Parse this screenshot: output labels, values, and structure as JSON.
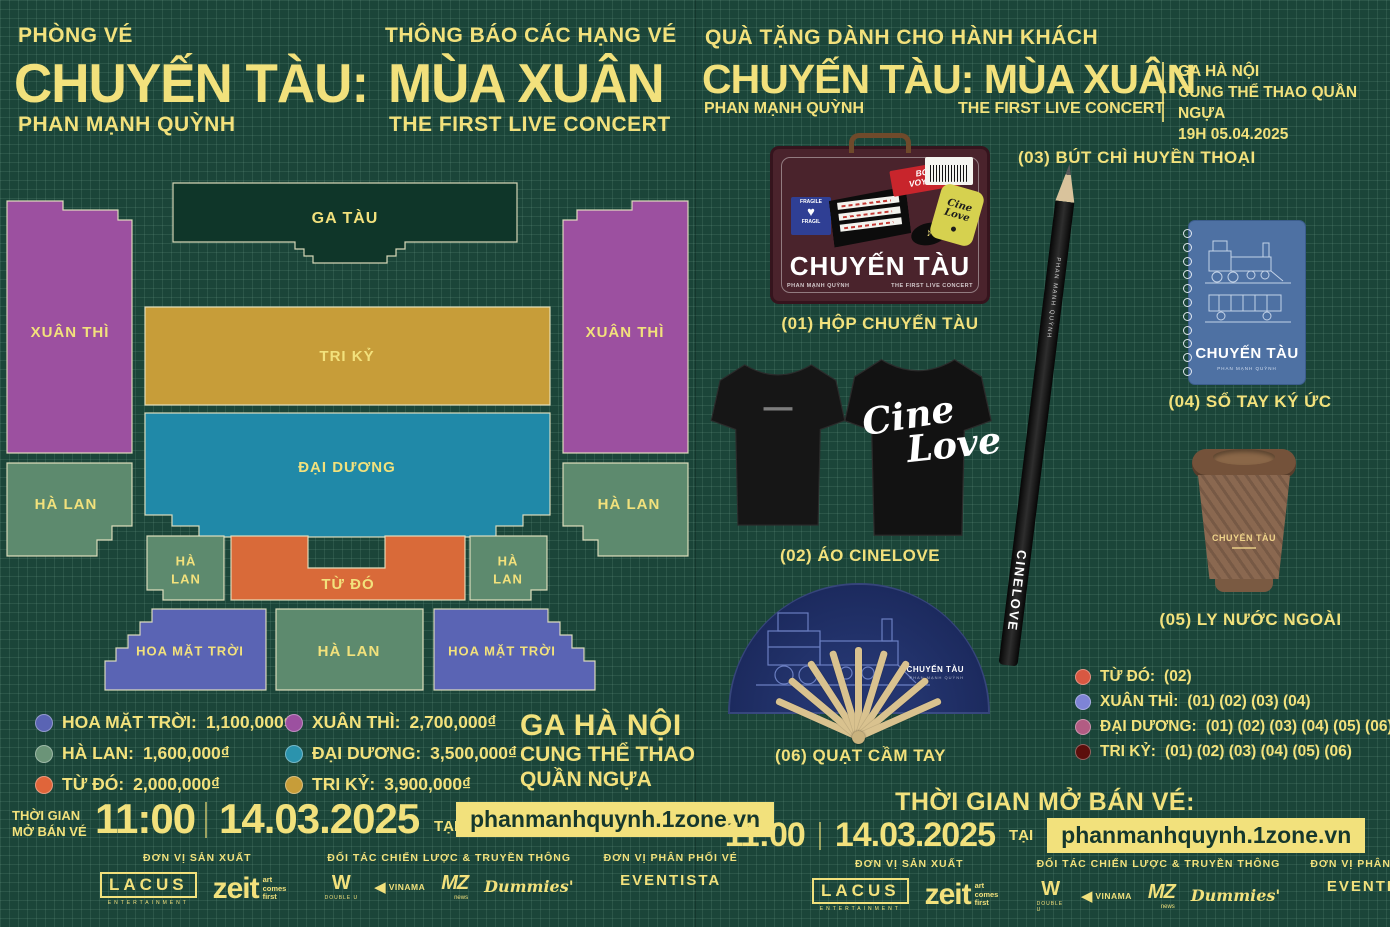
{
  "theme": {
    "bg": "#1b4539",
    "grid_line": "#8cc8af",
    "yellow": "#f2e17c",
    "stage_fill": "#0f3629",
    "url_box_bg": "#f2e17c",
    "url_box_text": "#16382d",
    "seat_colors": {
      "xuan_thi": "#9c50a0",
      "tri_ky": "#c79d39",
      "dai_duong": "#2089a8",
      "ha_lan": "#5d8a6e",
      "tu_do": "#d96a39",
      "hoa_mat_troi": "#5a64b4"
    },
    "gift_dot_colors": {
      "tu_do": "#d85842",
      "xuan_thi": "#7e84d6",
      "dai_duong": "#b25c83",
      "tri_ky": "#5c0f0c"
    },
    "icons": {
      "heart": "♥",
      "note": "♪"
    }
  },
  "left": {
    "kicker": "PHÒNG VÉ",
    "notice": "THÔNG BÁO CÁC HẠNG VÉ",
    "title_a": "CHUYẾN TÀU:",
    "title_b": "MÙA XUÂN",
    "artist": "PHAN MẠNH QUỲNH",
    "subtitle": "THE FIRST LIVE CONCERT",
    "map": {
      "stage": "GA TÀU",
      "xuan_thi": "XUÂN THÌ",
      "tri_ky": "TRI KỶ",
      "dai_duong": "ĐẠI DƯƠNG",
      "ha_lan": "HÀ LAN",
      "ha_lan_1": "HÀ",
      "ha_lan_2": "LAN",
      "tu_do": "TỪ ĐÓ",
      "hoa_mat_troi": "HOA MẶT TRỜI"
    },
    "legend": [
      {
        "label": "HOA MẶT TRỜI:",
        "price": "1,100,000₫"
      },
      {
        "label": "HÀ LAN:",
        "price": "1,600,000₫"
      },
      {
        "label": "TỪ ĐÓ:",
        "price": "2,000,000₫"
      },
      {
        "label": "XUÂN THÌ:",
        "price": "2,700,000₫"
      },
      {
        "label": "ĐẠI DƯƠNG:",
        "price": "3,500,000₫"
      },
      {
        "label": "TRI KỶ:",
        "price": "3,900,000₫"
      }
    ],
    "venue": {
      "line1": "GA HÀ NỘI",
      "line2": "CUNG THỂ THAO",
      "line3": "QUẦN NGỰA"
    },
    "sale": {
      "label_1": "THỜI GIAN",
      "label_2": "MỞ BÁN VÉ",
      "time": "11:00",
      "date": "14.03.2025",
      "at": "TẠI",
      "url": "phanmanhquynh.1zone.vn"
    }
  },
  "right": {
    "kicker": "QUÀ TẶNG DÀNH CHO HÀNH KHÁCH",
    "title": "CHUYẾN TÀU: MÙA XUÂN",
    "artist": "PHAN MẠNH QUỲNH",
    "subtitle": "THE FIRST LIVE CONCERT",
    "event_info": {
      "line1": "GA HÀ NỘI",
      "line2": "CUNG THỂ THAO QUẦN NGỰA",
      "line3": "19H 05.04.2025"
    },
    "gifts": {
      "g01": "(01) HỘP CHUYẾN TÀU",
      "g02": "(02) ÁO CINELOVE",
      "g03": "(03) BÚT CHÌ HUYỀN THOẠI",
      "g04": "(04) SỔ TAY KÝ ỨC",
      "g05": "(05) LY NƯỚC NGOÀI",
      "g06": "(06) QUẠT CẦM TAY"
    },
    "items": {
      "suitcase": {
        "title": "CHUYẾN TÀU",
        "artist": "PHAN MẠNH QUỲNH",
        "subtitle": "THE FIRST LIVE CONCERT",
        "sticker_fragile": "FRAGILE",
        "sticker_fragile_2": "FRAGIL",
        "sticker_bon_1": "BON",
        "sticker_bon_2": "VOYAGE",
        "sticker_cine": "Cine Love"
      },
      "tshirt_back_1": "Cine",
      "tshirt_back_2": "Love",
      "pencil_brand": "PHAN MẠNH QUỲNH",
      "pencil_text": "CINELOVE",
      "notebook_title": "CHUYẾN TÀU",
      "notebook_sub": "PHAN MẠNH QUỲNH",
      "cup_title": "CHUYẾN TÀU",
      "fan_title": "CHUYẾN TÀU",
      "fan_sub": "PHAN MẠNH QUỲNH"
    },
    "gift_map": [
      {
        "label": "TỪ ĐÓ:",
        "codes": "(02)"
      },
      {
        "label": "XUÂN THÌ:",
        "codes": "(01) (02) (03) (04)"
      },
      {
        "label": "ĐẠI DƯƠNG:",
        "codes": "(01) (02) (03) (04) (05) (06)"
      },
      {
        "label": "TRI KỶ:",
        "codes": "(01) (02) (03) (04) (05) (06)"
      }
    ],
    "sale": {
      "heading": "THỜI GIAN MỞ BÁN VÉ:",
      "time": "11:00",
      "date": "14.03.2025",
      "at": "TẠI",
      "url": "phanmanhquynh.1zone.vn"
    }
  },
  "footer": {
    "producer_label": "ĐƠN VỊ SẢN XUẤT",
    "partner_label": "ĐỐI TÁC CHIẾN LƯỢC & TRUYỀN THÔNG",
    "distributor_label": "ĐƠN VỊ PHÂN PHỐI VÉ",
    "logos": {
      "lacus": "LACUS",
      "lacus_sub": "ENTERTAINMENT",
      "zeit": "zeit",
      "zeit_sub": "art comes first",
      "double_u_glyph": "W",
      "double_u": "DOUBLE U",
      "vinama_glyph": "◀",
      "vinama": "VINAMA",
      "mz": "MZ",
      "mz_sub": "news",
      "dummies": "Dummies'",
      "eventista": "EVENTISTA"
    }
  }
}
